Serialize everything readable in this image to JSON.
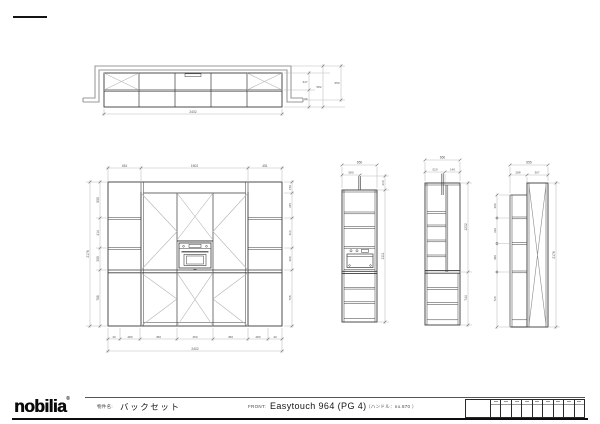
{
  "title_block": {
    "logo": "nobilia",
    "logo_mark": "®",
    "name_label": "物件名:",
    "name_value": "バックセット",
    "front_label": "FRONT:",
    "front_value": "Easytouch 964 (PG 4)",
    "note": "（ハンドル：no.870 ）"
  },
  "colors": {
    "line": "#3a3a3a",
    "wall": "#9a9a9a",
    "dim": "#bcbcbc",
    "accent": "#0d0d0d"
  },
  "dims": {
    "plan": {
      "width": "2402",
      "d1": "347",
      "d2": "96",
      "total": "582",
      "extra": "650"
    },
    "front": {
      "top1": "451",
      "top2": "1502",
      "top3": "451",
      "height": "2176",
      "l1": "500",
      "l2": "414",
      "l3": "300",
      "l4": "768",
      "r1": "150",
      "r2": "345",
      "r3": "414",
      "r4": "300",
      "r5": "768",
      "b1": "40",
      "b2": "280",
      "b3": "450",
      "b4": "450",
      "b5": "450",
      "b6": "280",
      "b7": "40",
      "total": "2402"
    },
    "side1": {
      "top": "650",
      "top2": "580",
      "r1": "210",
      "r2": "2111"
    },
    "side2": {
      "top": "660",
      "t2a": "520",
      "t2b": "140",
      "r1": "1232",
      "r2": "744"
    },
    "side3": {
      "top": "655",
      "t2a": "288",
      "t2b": "367",
      "l1": "300",
      "l2": "330",
      "l3": "380",
      "l4": "720",
      "right": "2176"
    }
  }
}
